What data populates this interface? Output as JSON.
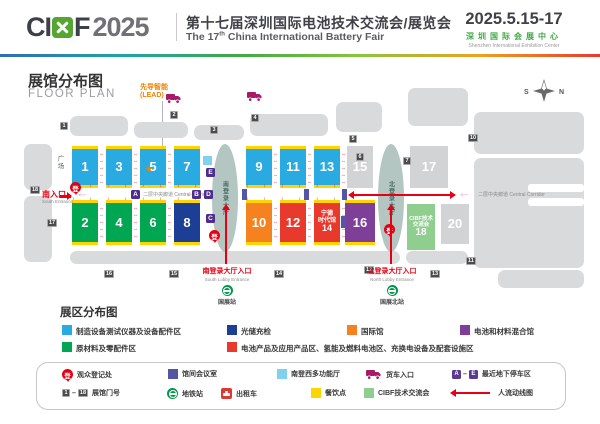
{
  "header": {
    "logo_ci": "CI",
    "logo_f": "F",
    "logo_year": "2025",
    "title_cn": "第十七届深圳国际电池技术交流会/展览会",
    "title_en_pre": "The 17",
    "title_en_sup": "th",
    "title_en_post": " China International Battery Fair",
    "date": "2025.5.15-17",
    "venue_cn": "深圳国际会展中心",
    "venue_en": "Shenzhen International Exhibition Center"
  },
  "map": {
    "title_cn": "展馆分布图",
    "title_en": "FLOOR PLAN",
    "lead_line1": "先导智能",
    "lead_line2": "(LEAD)",
    "compass_s": "S",
    "compass_n": "N",
    "plaza": "广场",
    "south_entrance_cn": "南入口",
    "south_entrance_en": "South Entrance",
    "corridor_label": "二层中央廊道 Central Corridor",
    "reg_glyph": "登",
    "south_hall": "南登录大厅",
    "north_hall": "北登录大厅",
    "south_lobby_cn": "南登录大厅入口",
    "south_lobby_en": "South Lobby Entrance",
    "north_lobby_cn": "北登录大厅入口",
    "north_lobby_en": "North Lobby Entrance",
    "metro_south": "国展站",
    "metro_north": "国展北站",
    "halls": {
      "h1": "1",
      "h2": "2",
      "h3": "3",
      "h4": "4",
      "h5": "5",
      "h6": "6",
      "h7": "7",
      "h8": "8",
      "h9": "9",
      "h10": "10",
      "h11": "11",
      "h12": "12",
      "h13": "13",
      "h14": "14",
      "h14_t1": "宁德",
      "h14_t2": "时代馆",
      "h15": "15",
      "h16": "16",
      "h17": "17",
      "h18": "18",
      "h18_t1": "CIBF技术",
      "h18_t2": "交流会",
      "h20": "20"
    },
    "letters": {
      "a": "A",
      "b": "B",
      "c": "C",
      "d": "D",
      "e": "E"
    },
    "gates": {
      "g1": "1",
      "g2": "2",
      "g3": "3",
      "g4": "4",
      "g5": "5",
      "g6": "6",
      "g7": "7",
      "g10": "10",
      "g11": "11",
      "g12": "12",
      "g13": "13",
      "g14": "14",
      "g15": "15",
      "g16": "16",
      "g17": "17",
      "g18": "18"
    }
  },
  "legend": {
    "title": "展区分布图",
    "zones": [
      {
        "label": "制造设备测试仪器及设备配件区",
        "color": "#29abe2"
      },
      {
        "label": "光储充检",
        "color": "#1c3e94"
      },
      {
        "label": "国际馆",
        "color": "#f5821f"
      },
      {
        "label": "电池和材料混合馆",
        "color": "#7d3f98"
      },
      {
        "label": "原材料及零配件区",
        "color": "#00a651"
      },
      {
        "label": "电池产品及应用产品区、氢能及燃料电池区、充换电设备及配套设施区",
        "color": "#e8392d"
      }
    ]
  },
  "facilities": {
    "reg": "观众登记处",
    "meeting": "馆间会议室",
    "multi_hall": "南登西多功能厅",
    "truck": "货车入口",
    "parking": "最近地下停车区",
    "parking_from": "A",
    "parking_to": "E",
    "sep": "–",
    "gate_no": "展馆门号",
    "gate_from": "1",
    "gate_to": "18",
    "metro": "地铁站",
    "taxi": "出租车",
    "food": "餐饮点",
    "cibf": "CIBF技术交流会",
    "flow": "人流动线图"
  },
  "colors": {
    "manufacturing": "#29abe2",
    "storage_charge": "#1c3e94",
    "materials": "#00a651",
    "battery_products": "#e8392d",
    "international": "#f5821f",
    "mixed_hall": "#7d3f98",
    "food_yellow": "#ffd400",
    "cibf_green": "#8fce8f",
    "flow_red": "#e60012",
    "truck_magenta": "#a81a68",
    "meeting_indigo": "#5456a5",
    "multi_blue": "#7fd1ee",
    "metro_green": "#00984b"
  }
}
